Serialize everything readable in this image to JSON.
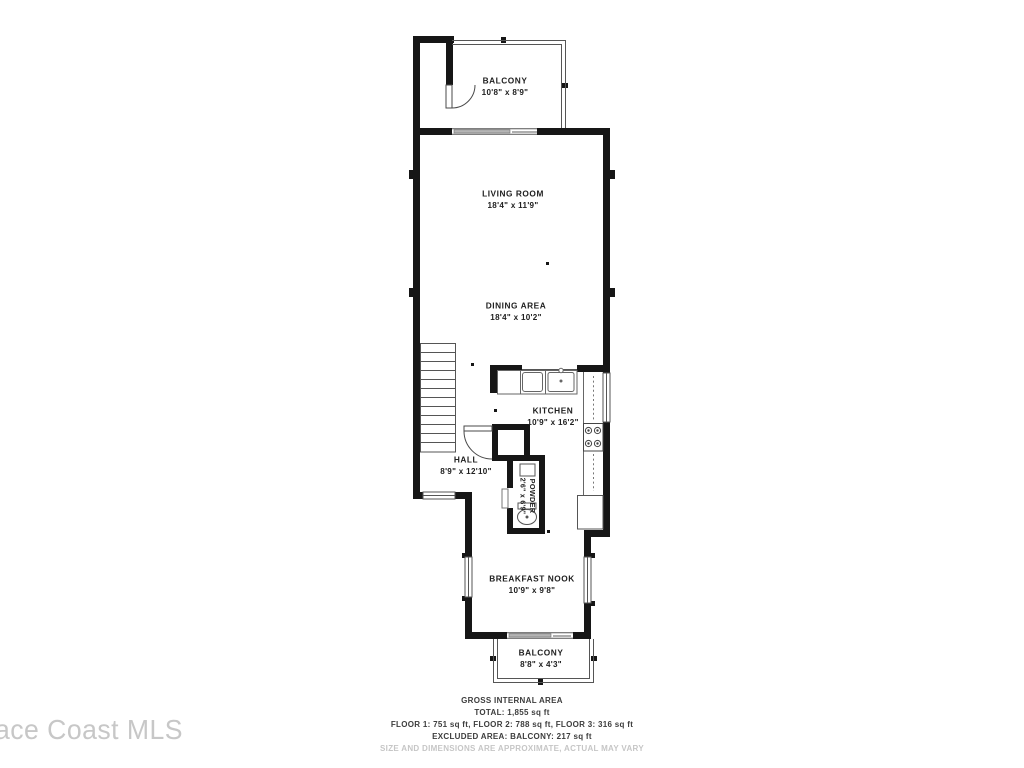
{
  "floorplan": {
    "rooms": [
      {
        "name": "BALCONY",
        "dims": "10'8\" x 8'9\""
      },
      {
        "name": "LIVING ROOM",
        "dims": "18'4\" x 11'9\""
      },
      {
        "name": "DINING AREA",
        "dims": "18'4\" x 10'2\""
      },
      {
        "name": "KITCHEN",
        "dims": "10'9\" x 16'2\""
      },
      {
        "name": "HALL",
        "dims": "8'9\" x 12'10\""
      },
      {
        "name": "POWDER",
        "dims": "2'6\" x 6'9\""
      },
      {
        "name": "BREAKFAST NOOK",
        "dims": "10'9\" x 9'8\""
      },
      {
        "name": "BALCONY",
        "dims": "8'8\" x 4'3\""
      }
    ],
    "summary": {
      "title": "GROSS INTERNAL AREA",
      "total": "TOTAL: 1,855 sq ft",
      "floors": "FLOOR 1: 751 sq ft, FLOOR 2: 788 sq ft, FLOOR 3: 316 sq ft",
      "excluded": "EXCLUDED AREA: BALCONY: 217 sq ft",
      "disclaimer": "SIZE AND DIMENSIONS ARE APPROXIMATE, ACTUAL MAY VARY"
    },
    "watermark": "ace Coast MLS",
    "colors": {
      "wall": "#161616",
      "line": "#555555",
      "slider_panel": "#b5b5b5",
      "label_text": "#202020",
      "disclaimer_text": "#c6c6c6",
      "watermark_text": "#c7c7c7"
    }
  }
}
